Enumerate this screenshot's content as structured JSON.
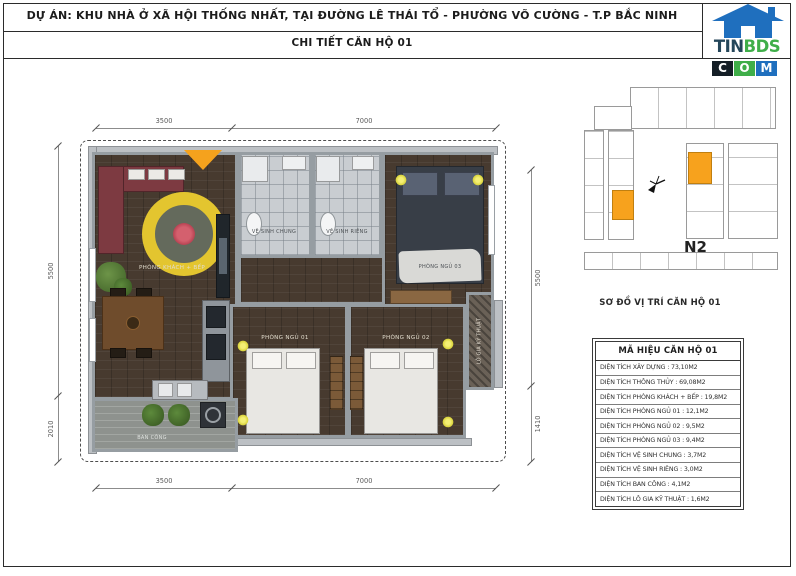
{
  "header": {
    "project_title": "DỰ ÁN: KHU NHÀ Ở XÃ HỘI THỐNG NHẤT, TẠI ĐƯỜNG LÊ THÁI TỔ - PHƯỜNG VÕ CƯỜNG - T.P BẮC NINH",
    "detail_title": "CHI TIẾT CĂN HỘ 01"
  },
  "logo": {
    "text_top_left": "TIN",
    "text_top_right": "BDS",
    "letters": [
      "C",
      "O",
      "M"
    ],
    "colors": {
      "house_blue": "#1f6fbe",
      "tin_dark": "#24465a",
      "bds_green": "#3fae49",
      "c_bg": "#141e26",
      "o_bg": "#3fae49",
      "m_bg": "#1f6fbe"
    }
  },
  "floor_plan": {
    "entrance_marker_color": "#f5a21d",
    "rooms": {
      "living": "PHÒNG KHÁCH + BẾP",
      "bath_shared": "VỆ SINH CHUNG",
      "bath_private": "VỆ SINH RIÊNG",
      "bedroom1": "PHÒNG NGỦ 01",
      "bedroom2": "PHÒNG NGỦ 02",
      "bedroom3": "PHÒNG NGỦ 03",
      "balcony": "BAN CÔNG",
      "loggia": "LÔ GIA KỸ THUẬT"
    },
    "dimensions": {
      "top": [
        "3500",
        "7000"
      ],
      "bottom": [
        "3500",
        "7000"
      ],
      "left": [
        "5500",
        "2010"
      ],
      "right": [
        "5500",
        "1410"
      ]
    }
  },
  "location_panel": {
    "block_label": "N2",
    "caption": "SƠ ĐỒ VỊ TRÍ CĂN HỘ 01",
    "highlight_color": "#f7a21d"
  },
  "info_table": {
    "title": "MÃ HIỆU CĂN HỘ 01",
    "separator": " : ",
    "rows": [
      {
        "label": "DIỆN TÍCH XÂY DỰNG",
        "value": "73,10M2"
      },
      {
        "label": "DIỆN TÍCH THÔNG THỦY",
        "value": "69,08M2"
      },
      {
        "label": "DIỆN TÍCH PHÒNG KHÁCH + BẾP",
        "value": "19,8M2"
      },
      {
        "label": "DIỆN TÍCH PHÒNG NGỦ 01",
        "value": "12,1M2"
      },
      {
        "label": "DIỆN TÍCH PHÒNG NGỦ 02",
        "value": "9,5M2"
      },
      {
        "label": "DIỆN TÍCH PHÒNG NGỦ 03",
        "value": "9,4M2"
      },
      {
        "label": "DIỆN TÍCH VỆ SINH CHUNG",
        "value": "3,7M2"
      },
      {
        "label": "DIỆN TÍCH VỆ SINH RIÊNG",
        "value": "3,0M2"
      },
      {
        "label": "DIỆN TÍCH BAN CÔNG",
        "value": "4,1M2"
      },
      {
        "label": "DIỆN TÍCH LÔ GIA KỸ THUẬT",
        "value": "1,6M2"
      }
    ]
  }
}
